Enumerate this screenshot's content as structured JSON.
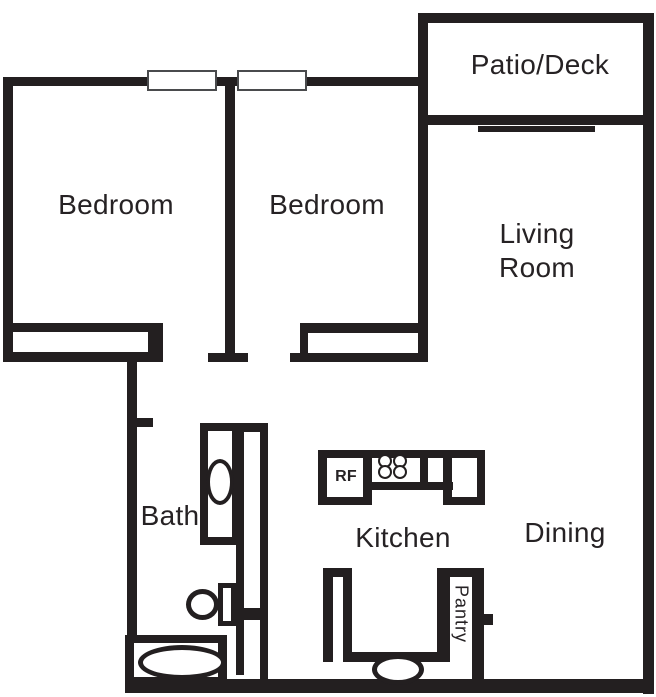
{
  "rooms": {
    "patio": {
      "label": "Patio/Deck"
    },
    "bedroom1": {
      "label": "Bedroom"
    },
    "bedroom2": {
      "label": "Bedroom"
    },
    "living": {
      "line1": "Living",
      "line2": "Room"
    },
    "bath": {
      "label": "Bath"
    },
    "kitchen": {
      "label": "Kitchen"
    },
    "dining": {
      "label": "Dining"
    },
    "pantry": {
      "label": "Pantry"
    },
    "refrigerator": {
      "label": "RF"
    }
  },
  "colors": {
    "wall": "#231f20",
    "ink": "#262224",
    "background": "#ffffff",
    "window_outline": "#4a4b4d"
  }
}
